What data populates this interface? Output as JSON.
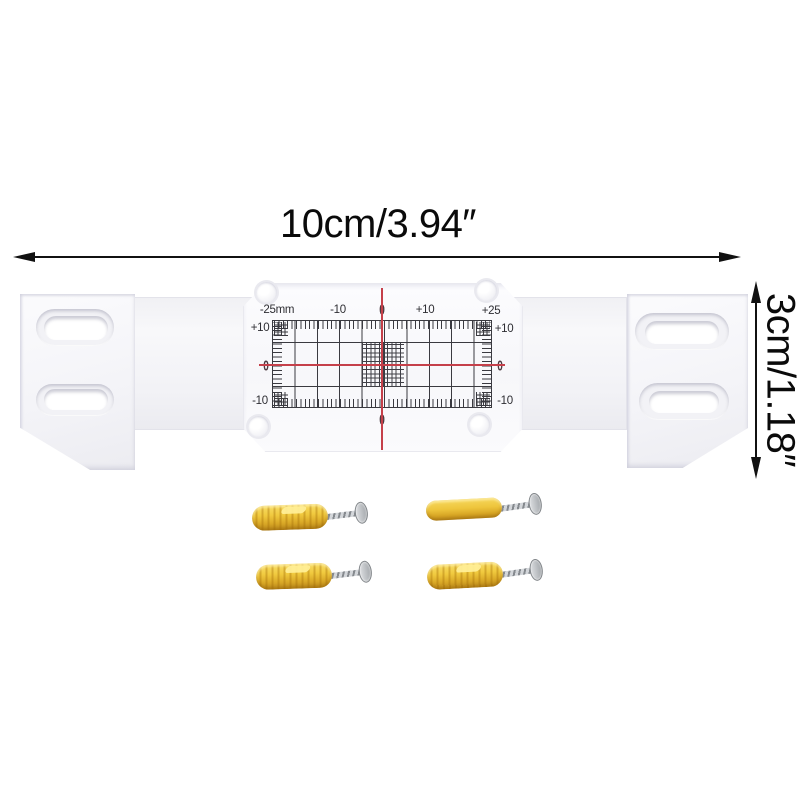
{
  "scene": {
    "subject": "crack monitor gauge product photo",
    "background_color": "#ffffff"
  },
  "annotations": {
    "width_label": "10cm/3.94″",
    "height_label": "3cm/1.18″",
    "line_color": "#111111"
  },
  "gauge": {
    "top_labels": [
      "-25mm",
      "-10",
      "0",
      "+10",
      "+25"
    ],
    "left_labels": [
      "+10",
      "0",
      "-10"
    ],
    "right_labels": [
      "+10",
      "0",
      "-10"
    ],
    "bottom_labels": [
      "0"
    ],
    "crosshair_color": "#c5404a",
    "grid_color": "#3a3a40",
    "plate_color": "#fafafc"
  },
  "hardware": {
    "anchors_count": 4,
    "plug_color": "#eec43a",
    "screw_color": "#b4b7bb"
  }
}
